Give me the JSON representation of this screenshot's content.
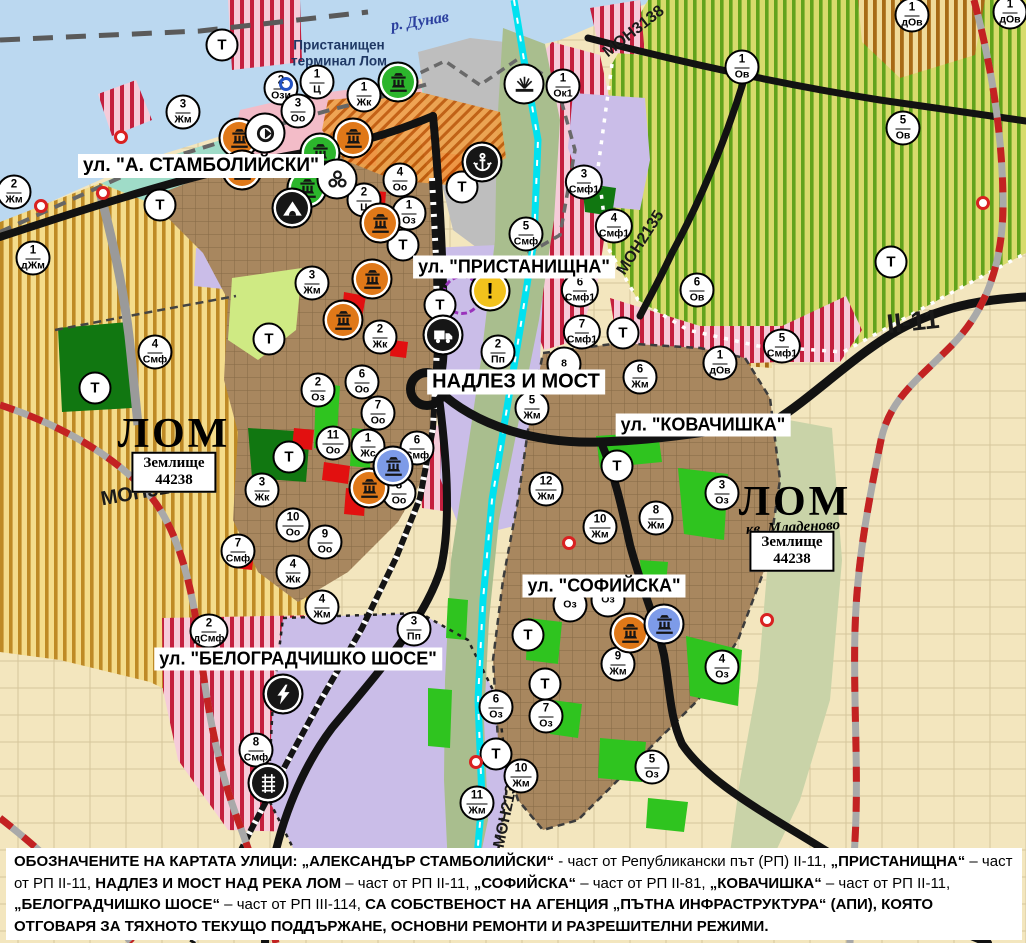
{
  "map": {
    "t_label": "Т",
    "exclamation_glyph": "!",
    "street_labels": [
      {
        "text": "ул. \"А. СТАМБОЛИЙСКИ\"",
        "x": 201,
        "y": 166,
        "fs": 19
      },
      {
        "text": "ул. \"ПРИСТАНИЩНА\"",
        "x": 514,
        "y": 267,
        "fs": 18
      },
      {
        "text": "НАДЛЕЗ И МОСТ",
        "x": 516,
        "y": 382,
        "fs": 20
      },
      {
        "text": "ул. \"КОВАЧИШКА\"",
        "x": 703,
        "y": 425,
        "fs": 18
      },
      {
        "text": "ул. \"СОФИЙСКА\"",
        "x": 604,
        "y": 586,
        "fs": 18
      },
      {
        "text": "ул. \"БЕЛОГРАДЧИШКО ШОСЕ\"",
        "x": 298,
        "y": 659,
        "fs": 18
      }
    ],
    "road_codes": [
      {
        "text": "МОН3139",
        "x": 146,
        "y": 492,
        "fs": 20,
        "rot": -10
      },
      {
        "text": "МОН3138",
        "x": 634,
        "y": 32,
        "fs": 16,
        "rot": -38
      },
      {
        "text": "МОН2135",
        "x": 641,
        "y": 243,
        "fs": 16,
        "rot": -57
      },
      {
        "text": "МОН2136",
        "x": 507,
        "y": 812,
        "fs": 16,
        "rot": -78
      },
      {
        "text": "II-11",
        "x": 913,
        "y": 322,
        "fs": 27,
        "rot": -6
      }
    ],
    "area_labels": [
      {
        "name": "river-label",
        "text": "р. Дунав",
        "x": 420,
        "y": 22,
        "fs": 16,
        "cls": "water",
        "rot": -9
      },
      {
        "name": "port-terminal-label",
        "text": "Пристанищен\nтерминал Лом",
        "x": 339,
        "y": 53,
        "fs": 13.5,
        "cls": "terminal",
        "rot": 0
      },
      {
        "name": "city-label-lom-west",
        "text": "ЛОМ",
        "x": 174,
        "y": 434,
        "fs": 42,
        "cls": "city",
        "rot": 0
      },
      {
        "name": "city-label-lom-mladenovo",
        "text": "ЛОМ",
        "x": 795,
        "y": 502,
        "fs": 42,
        "cls": "city",
        "rot": 0
      },
      {
        "name": "district-label-mladenovo",
        "text": "кв. Младеново",
        "x": 793,
        "y": 528,
        "fs": 15,
        "cls": "sub",
        "rot": -3
      }
    ],
    "territory_boxes": [
      {
        "lines": [
          "Землище",
          "44238"
        ],
        "x": 174,
        "y": 472
      },
      {
        "lines": [
          "Землище",
          "44238"
        ],
        "x": 792,
        "y": 551
      }
    ],
    "zone_markers": [
      {
        "n": "2",
        "c": "Жм",
        "x": 14,
        "y": 192
      },
      {
        "n": "3",
        "c": "Жм",
        "x": 183,
        "y": 112
      },
      {
        "n": "1",
        "c": "дЖм",
        "x": 33,
        "y": 258
      },
      {
        "n": "4",
        "c": "Смф",
        "x": 155,
        "y": 352
      },
      {
        "n": "2",
        "c": "Ози",
        "x": 281,
        "y": 88
      },
      {
        "n": "1",
        "c": "Ц",
        "x": 317,
        "y": 82
      },
      {
        "n": "1",
        "c": "Жк",
        "x": 364,
        "y": 95
      },
      {
        "n": "3",
        "c": "Оо",
        "x": 298,
        "y": 111
      },
      {
        "n": "4",
        "c": "Оо",
        "x": 400,
        "y": 180
      },
      {
        "n": "2",
        "c": "Ц",
        "x": 364,
        "y": 200
      },
      {
        "n": "1",
        "c": "Оз",
        "x": 409,
        "y": 213
      },
      {
        "n": "3",
        "c": "Жм",
        "x": 312,
        "y": 283
      },
      {
        "n": "2",
        "c": "Жк",
        "x": 380,
        "y": 337
      },
      {
        "n": "6",
        "c": "Оо",
        "x": 362,
        "y": 382
      },
      {
        "n": "7",
        "c": "Оо",
        "x": 378,
        "y": 413
      },
      {
        "n": "2",
        "c": "Оз",
        "x": 318,
        "y": 390
      },
      {
        "n": "11",
        "c": "Оо",
        "x": 333,
        "y": 443
      },
      {
        "n": "1",
        "c": "Жс",
        "x": 368,
        "y": 446
      },
      {
        "n": "6",
        "c": "Смф",
        "x": 417,
        "y": 448
      },
      {
        "n": "8",
        "c": "Оо",
        "x": 399,
        "y": 493
      },
      {
        "n": "3",
        "c": "Жк",
        "x": 262,
        "y": 490
      },
      {
        "n": "10",
        "c": "Оо",
        "x": 293,
        "y": 525
      },
      {
        "n": "9",
        "c": "Оо",
        "x": 325,
        "y": 542
      },
      {
        "n": "7",
        "c": "Смф",
        "x": 238,
        "y": 551
      },
      {
        "n": "4",
        "c": "Жк",
        "x": 293,
        "y": 572
      },
      {
        "n": "4",
        "c": "Жм",
        "x": 322,
        "y": 607
      },
      {
        "n": "2",
        "c": "дСмф",
        "x": 209,
        "y": 631
      },
      {
        "n": "3",
        "c": "Пп",
        "x": 414,
        "y": 629
      },
      {
        "n": "8",
        "c": "Смф",
        "x": 256,
        "y": 750
      },
      {
        "n": "1",
        "c": "Ок1",
        "x": 563,
        "y": 86
      },
      {
        "n": "3",
        "c": "Смф1",
        "x": 584,
        "y": 182
      },
      {
        "n": "4",
        "c": "Смф1",
        "x": 614,
        "y": 226
      },
      {
        "n": "5",
        "c": "Смф",
        "x": 526,
        "y": 234
      },
      {
        "n": "6",
        "c": "Смф1",
        "x": 580,
        "y": 290
      },
      {
        "n": "7",
        "c": "Смф1",
        "x": 582,
        "y": 332
      },
      {
        "n": "8",
        "c": "",
        "x": 564,
        "y": 364
      },
      {
        "n": "2",
        "c": "Пп",
        "x": 498,
        "y": 352
      },
      {
        "n": "5",
        "c": "Жм",
        "x": 532,
        "y": 408
      },
      {
        "n": "6",
        "c": "Жм",
        "x": 640,
        "y": 377
      },
      {
        "n": "12",
        "c": "Жм",
        "x": 546,
        "y": 489
      },
      {
        "n": "1",
        "c": "Ов",
        "x": 742,
        "y": 67
      },
      {
        "n": "6",
        "c": "Ов",
        "x": 697,
        "y": 290
      },
      {
        "n": "5",
        "c": "Ов",
        "x": 903,
        "y": 128
      },
      {
        "n": "1",
        "c": "дОв",
        "x": 912,
        "y": 15
      },
      {
        "n": "1",
        "c": "дОв",
        "x": 720,
        "y": 363
      },
      {
        "n": "1",
        "c": "дОв",
        "x": 1010,
        "y": 12
      },
      {
        "n": "5",
        "c": "Смф1",
        "x": 782,
        "y": 346
      },
      {
        "n": "8",
        "c": "Жм",
        "x": 656,
        "y": 518
      },
      {
        "n": "3",
        "c": "Оз",
        "x": 722,
        "y": 493
      },
      {
        "n": "10",
        "c": "Жм",
        "x": 600,
        "y": 527
      },
      {
        "n": "",
        "c": "Оз",
        "x": 570,
        "y": 605
      },
      {
        "n": "",
        "c": "Оз",
        "x": 608,
        "y": 600
      },
      {
        "n": "9",
        "c": "Жм",
        "x": 618,
        "y": 664
      },
      {
        "n": "4",
        "c": "Оз",
        "x": 722,
        "y": 667
      },
      {
        "n": "6",
        "c": "Оз",
        "x": 496,
        "y": 707
      },
      {
        "n": "7",
        "c": "Оз",
        "x": 546,
        "y": 716
      },
      {
        "n": "10",
        "c": "Жм",
        "x": 521,
        "y": 776
      },
      {
        "n": "11",
        "c": "Жм",
        "x": 477,
        "y": 803
      },
      {
        "n": "5",
        "c": "Оз",
        "x": 652,
        "y": 767
      }
    ],
    "t_markers": [
      {
        "x": 222,
        "y": 45
      },
      {
        "x": 160,
        "y": 205
      },
      {
        "x": 462,
        "y": 187
      },
      {
        "x": 403,
        "y": 245
      },
      {
        "x": 440,
        "y": 305
      },
      {
        "x": 269,
        "y": 339
      },
      {
        "x": 289,
        "y": 457
      },
      {
        "x": 95,
        "y": 388
      },
      {
        "x": 891,
        "y": 262
      },
      {
        "x": 623,
        "y": 333
      },
      {
        "x": 617,
        "y": 466
      },
      {
        "x": 528,
        "y": 635
      },
      {
        "x": 545,
        "y": 684
      },
      {
        "x": 496,
        "y": 754
      }
    ],
    "icon_colors": {
      "orange": "#E07818",
      "green": "#2CB52C",
      "blue": "#7D9BE8",
      "black": "#161616",
      "white": "#ffffff",
      "yellow": "#F2C21C"
    },
    "icons": [
      {
        "type": "monument",
        "bg": "orange",
        "x": 239,
        "y": 138
      },
      {
        "type": "monument",
        "bg": "orange",
        "x": 242,
        "y": 170
      },
      {
        "type": "monument",
        "bg": "orange",
        "x": 353,
        "y": 138
      },
      {
        "type": "monument",
        "bg": "orange",
        "x": 380,
        "y": 223
      },
      {
        "type": "monument",
        "bg": "orange",
        "x": 372,
        "y": 279
      },
      {
        "type": "monument",
        "bg": "orange",
        "x": 343,
        "y": 320
      },
      {
        "type": "monument",
        "bg": "orange",
        "x": 369,
        "y": 488
      },
      {
        "type": "monument",
        "bg": "orange",
        "x": 630,
        "y": 633
      },
      {
        "type": "monument",
        "bg": "green",
        "x": 398,
        "y": 82
      },
      {
        "type": "monument",
        "bg": "green",
        "x": 320,
        "y": 153
      },
      {
        "type": "monument",
        "bg": "green",
        "x": 307,
        "y": 188
      },
      {
        "type": "monument",
        "bg": "blue",
        "x": 393,
        "y": 466
      },
      {
        "type": "monument",
        "bg": "blue",
        "x": 664,
        "y": 624
      },
      {
        "type": "circular-arrow",
        "bg": "white",
        "x": 265,
        "y": 133
      },
      {
        "type": "trefoil",
        "bg": "white",
        "x": 337,
        "y": 179
      },
      {
        "type": "cave",
        "bg": "black",
        "x": 292,
        "y": 208
      },
      {
        "type": "anchor",
        "bg": "black",
        "x": 482,
        "y": 162
      },
      {
        "type": "fan",
        "bg": "white",
        "x": 524,
        "y": 84
      },
      {
        "type": "exclamation",
        "bg": "yellow",
        "x": 490,
        "y": 291
      },
      {
        "type": "truck",
        "bg": "black",
        "x": 443,
        "y": 335
      },
      {
        "type": "lightning",
        "bg": "black",
        "x": 283,
        "y": 694
      },
      {
        "type": "railway-crossing",
        "bg": "black",
        "x": 268,
        "y": 783
      }
    ],
    "point_symbols": [
      {
        "kind": "dot-red",
        "name": "red-point-icon",
        "x": 121,
        "y": 137
      },
      {
        "kind": "dot-red",
        "name": "red-point-icon",
        "x": 103,
        "y": 193
      },
      {
        "kind": "dot-red",
        "name": "red-point-icon",
        "x": 41,
        "y": 206
      },
      {
        "kind": "dot-red",
        "name": "red-point-icon",
        "x": 569,
        "y": 543
      },
      {
        "kind": "dot-red",
        "name": "red-point-icon",
        "x": 476,
        "y": 762
      },
      {
        "kind": "dot-red",
        "name": "red-point-icon",
        "x": 983,
        "y": 203
      },
      {
        "kind": "dot-red",
        "name": "red-point-icon",
        "x": 767,
        "y": 620
      },
      {
        "kind": "ring-blue",
        "name": "blue-ring-icon",
        "x": 286,
        "y": 84
      },
      {
        "kind": "circle-restricted",
        "name": "restricted-area-circle-icon",
        "x": 462,
        "y": 295
      },
      {
        "kind": "junction-ring",
        "name": "overpass-junction-icon",
        "x": 427,
        "y": 389
      }
    ],
    "colors": {
      "road": "#111111",
      "water": "#BBD8F0",
      "canal": "#00E2F0",
      "boundary_red": "#C32222",
      "city_fill": "#A8875F",
      "purple_zone": "#CABDE8"
    }
  },
  "footer": {
    "segments": [
      {
        "t": "ОБОЗНАЧЕНИТЕ НА КАРТАТА УЛИЦИ: „АЛЕКСАНДЪР СТАМБОЛИЙСКИ“",
        "b": 1
      },
      {
        "t": " - част от Републикански път (РП) II-11, ",
        "b": 0
      },
      {
        "t": "„ПРИСТАНИЩНА“",
        "b": 1
      },
      {
        "t": " – част от РП II-11, ",
        "b": 0
      },
      {
        "t": "НАДЛЕЗ И МОСТ НАД РЕКА ЛОМ",
        "b": 1
      },
      {
        "t": " – част от РП II-11, ",
        "b": 0
      },
      {
        "t": "„СОФИЙСКА“",
        "b": 1
      },
      {
        "t": " – част от РП II-81, ",
        "b": 0
      },
      {
        "t": "„КОВАЧИШКА“",
        "b": 1
      },
      {
        "t": " – част от РП II-11, ",
        "b": 0
      },
      {
        "t": "„БЕЛОГРАДЧИШКО ШОСЕ“",
        "b": 1
      },
      {
        "t": " – част от РП III-114, ",
        "b": 0
      },
      {
        "t": "СА СОБСТВЕНОСТ НА АГЕНЦИЯ „ПЪТНА ИНФРАСТРУКТУРА“ (АПИ), КОЯТО ОТГОВАРЯ ЗА ТЯХНОТО ТЕКУЩО ПОДДЪРЖАНЕ, ОСНОВНИ РЕМОНТИ И РАЗРЕШИТЕЛНИ РЕЖИМИ.",
        "b": 1
      }
    ]
  }
}
